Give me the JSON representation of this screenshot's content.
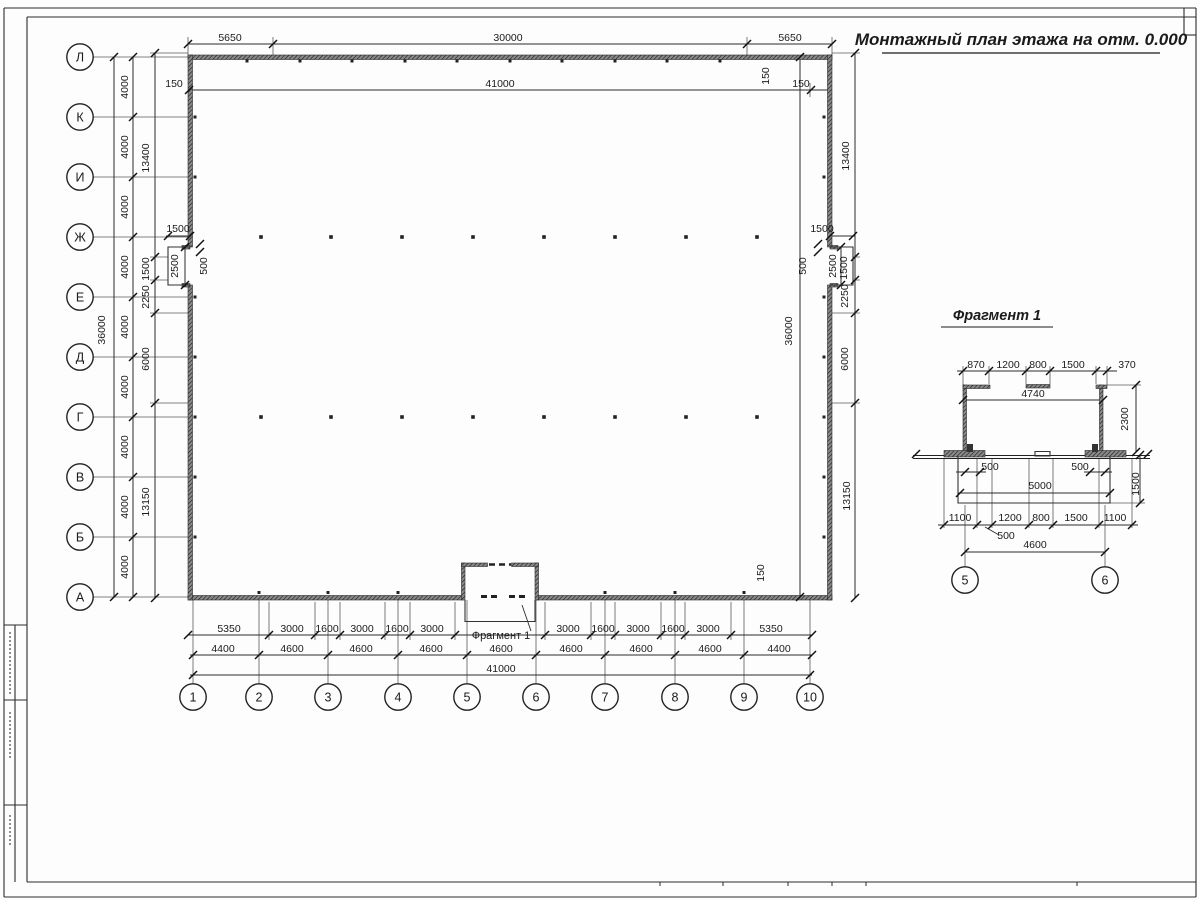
{
  "sheet": {
    "title": "Монтажный план этажа на отм. 0.000",
    "fragment_title": "Фрагмент 1",
    "fragment_callout": "Фрагмент 1"
  },
  "row_axes": [
    {
      "label": "Л",
      "y": 57
    },
    {
      "label": "К",
      "y": 117
    },
    {
      "label": "И",
      "y": 177
    },
    {
      "label": "Ж",
      "y": 237
    },
    {
      "label": "Е",
      "y": 297
    },
    {
      "label": "Д",
      "y": 357
    },
    {
      "label": "Г",
      "y": 417
    },
    {
      "label": "В",
      "y": 477
    },
    {
      "label": "Б",
      "y": 537
    },
    {
      "label": "А",
      "y": 597
    }
  ],
  "col_axes": [
    {
      "label": "1",
      "x": 193
    },
    {
      "label": "2",
      "x": 259
    },
    {
      "label": "3",
      "x": 328
    },
    {
      "label": "4",
      "x": 398
    },
    {
      "label": "5",
      "x": 467
    },
    {
      "label": "6",
      "x": 536
    },
    {
      "label": "7",
      "x": 605
    },
    {
      "label": "8",
      "x": 675
    },
    {
      "label": "9",
      "x": 744
    },
    {
      "label": "10",
      "x": 810
    }
  ],
  "frag_axes": [
    {
      "label": "5",
      "x": 965
    },
    {
      "label": "6",
      "x": 1105
    }
  ],
  "dim_labels": [
    {
      "t": "5650",
      "x": 230,
      "y": 41
    },
    {
      "t": "30000",
      "x": 508,
      "y": 41
    },
    {
      "t": "5650",
      "x": 790,
      "y": 41
    },
    {
      "t": "150",
      "x": 174,
      "y": 87
    },
    {
      "t": "41000",
      "x": 500,
      "y": 87
    },
    {
      "t": "150",
      "x": 801,
      "y": 87
    },
    {
      "t": "150",
      "x": 769,
      "y": 76,
      "r": 1
    },
    {
      "t": "36000",
      "x": 105,
      "y": 330,
      "r": 1
    },
    {
      "t": "4000",
      "x": 128,
      "y": 87,
      "r": 1
    },
    {
      "t": "4000",
      "x": 128,
      "y": 147,
      "r": 1
    },
    {
      "t": "4000",
      "x": 128,
      "y": 207,
      "r": 1
    },
    {
      "t": "4000",
      "x": 128,
      "y": 267,
      "r": 1
    },
    {
      "t": "4000",
      "x": 128,
      "y": 327,
      "r": 1
    },
    {
      "t": "4000",
      "x": 128,
      "y": 387,
      "r": 1
    },
    {
      "t": "4000",
      "x": 128,
      "y": 447,
      "r": 1
    },
    {
      "t": "4000",
      "x": 128,
      "y": 507,
      "r": 1
    },
    {
      "t": "4000",
      "x": 128,
      "y": 567,
      "r": 1
    },
    {
      "t": "13400",
      "x": 149,
      "y": 158,
      "r": 1
    },
    {
      "t": "1500",
      "x": 149,
      "y": 269,
      "r": 1
    },
    {
      "t": "2250",
      "x": 149,
      "y": 297,
      "r": 1
    },
    {
      "t": "6000",
      "x": 149,
      "y": 359,
      "r": 1
    },
    {
      "t": "13150",
      "x": 149,
      "y": 502,
      "r": 1
    },
    {
      "t": "1500",
      "x": 178,
      "y": 232
    },
    {
      "t": "2500",
      "x": 178,
      "y": 266,
      "r": 1
    },
    {
      "t": "500",
      "x": 207,
      "y": 266,
      "r": 1
    },
    {
      "t": "1500",
      "x": 822,
      "y": 232
    },
    {
      "t": "2500",
      "x": 836,
      "y": 266,
      "r": 1
    },
    {
      "t": "500",
      "x": 806,
      "y": 266,
      "r": 1
    },
    {
      "t": "13400",
      "x": 849,
      "y": 156,
      "r": 1
    },
    {
      "t": "1500",
      "x": 847,
      "y": 268,
      "r": 1
    },
    {
      "t": "2250",
      "x": 848,
      "y": 296,
      "r": 1
    },
    {
      "t": "6000",
      "x": 848,
      "y": 359,
      "r": 1
    },
    {
      "t": "13150",
      "x": 850,
      "y": 496,
      "r": 1
    },
    {
      "t": "36000",
      "x": 792,
      "y": 331,
      "r": 1
    },
    {
      "t": "150",
      "x": 764,
      "y": 573,
      "r": 1
    },
    {
      "t": "5350",
      "x": 229,
      "y": 632
    },
    {
      "t": "3000",
      "x": 292,
      "y": 632
    },
    {
      "t": "1600",
      "x": 327,
      "y": 632
    },
    {
      "t": "3000",
      "x": 362,
      "y": 632
    },
    {
      "t": "1600",
      "x": 397,
      "y": 632
    },
    {
      "t": "3000",
      "x": 432,
      "y": 632
    },
    {
      "t": "3000",
      "x": 568,
      "y": 632
    },
    {
      "t": "1600",
      "x": 603,
      "y": 632
    },
    {
      "t": "3000",
      "x": 638,
      "y": 632
    },
    {
      "t": "1600",
      "x": 673,
      "y": 632
    },
    {
      "t": "3000",
      "x": 708,
      "y": 632
    },
    {
      "t": "5350",
      "x": 771,
      "y": 632
    },
    {
      "t": "4400",
      "x": 223,
      "y": 652
    },
    {
      "t": "4600",
      "x": 292,
      "y": 652
    },
    {
      "t": "4600",
      "x": 361,
      "y": 652
    },
    {
      "t": "4600",
      "x": 431,
      "y": 652
    },
    {
      "t": "4600",
      "x": 501,
      "y": 652
    },
    {
      "t": "4600",
      "x": 571,
      "y": 652
    },
    {
      "t": "4600",
      "x": 641,
      "y": 652
    },
    {
      "t": "4600",
      "x": 710,
      "y": 652
    },
    {
      "t": "4400",
      "x": 779,
      "y": 652
    },
    {
      "t": "41000",
      "x": 501,
      "y": 672
    },
    {
      "t": "870",
      "x": 976,
      "y": 368
    },
    {
      "t": "1200",
      "x": 1008,
      "y": 368
    },
    {
      "t": "800",
      "x": 1038,
      "y": 368
    },
    {
      "t": "1500",
      "x": 1073,
      "y": 368
    },
    {
      "t": "370",
      "x": 1127,
      "y": 368
    },
    {
      "t": "4740",
      "x": 1033,
      "y": 397
    },
    {
      "t": "2300",
      "x": 1128,
      "y": 419,
      "r": 1
    },
    {
      "t": "500",
      "x": 990,
      "y": 470
    },
    {
      "t": "500",
      "x": 1080,
      "y": 470
    },
    {
      "t": "5000",
      "x": 1040,
      "y": 489
    },
    {
      "t": "1500",
      "x": 1139,
      "y": 484,
      "r": 1
    },
    {
      "t": "1100",
      "x": 960,
      "y": 521
    },
    {
      "t": "1200",
      "x": 1010,
      "y": 521
    },
    {
      "t": "800",
      "x": 1041,
      "y": 521
    },
    {
      "t": "1500",
      "x": 1076,
      "y": 521
    },
    {
      "t": "1100",
      "x": 1115,
      "y": 521
    },
    {
      "t": "500",
      "x": 1006,
      "y": 539
    },
    {
      "t": "4600",
      "x": 1035,
      "y": 548
    }
  ],
  "geometry": {
    "dim_h": [
      [
        44,
        188,
        832
      ],
      [
        90,
        188,
        832
      ],
      [
        635,
        188,
        812
      ],
      [
        655,
        190,
        812
      ],
      [
        675,
        190,
        812
      ],
      [
        236,
        166,
        191
      ],
      [
        236,
        830,
        855
      ],
      [
        371,
        957,
        1117
      ],
      [
        400,
        963,
        1103
      ],
      [
        493,
        958,
        1110
      ],
      [
        525,
        938,
        1138
      ],
      [
        552,
        965,
        1105
      ],
      [
        472,
        956,
        986
      ],
      [
        472,
        1084,
        1112
      ]
    ],
    "dim_v": [
      [
        114,
        57,
        597
      ],
      [
        133,
        57,
        597
      ],
      [
        155,
        53,
        598
      ],
      [
        800,
        57,
        597
      ],
      [
        855,
        53,
        598
      ],
      [
        185,
        247,
        285
      ],
      [
        841,
        247,
        285
      ],
      [
        1136,
        385,
        452
      ],
      [
        1140,
        455,
        503
      ]
    ],
    "ext_v": [
      [
        188,
        37,
        55
      ],
      [
        273,
        37,
        55
      ],
      [
        747,
        37,
        55
      ],
      [
        832,
        37,
        55
      ],
      [
        190,
        83,
        97
      ],
      [
        810,
        83,
        97
      ],
      [
        269,
        602,
        640
      ],
      [
        315,
        602,
        640
      ],
      [
        340,
        602,
        640
      ],
      [
        385,
        602,
        640
      ],
      [
        410,
        602,
        640
      ],
      [
        455,
        602,
        640
      ],
      [
        545,
        602,
        640
      ],
      [
        591,
        602,
        640
      ],
      [
        615,
        602,
        640
      ],
      [
        661,
        602,
        640
      ],
      [
        685,
        602,
        640
      ],
      [
        731,
        602,
        640
      ],
      [
        963,
        366,
        385
      ],
      [
        989,
        366,
        384
      ],
      [
        1026,
        366,
        384
      ],
      [
        1050,
        366,
        384
      ],
      [
        1096,
        366,
        384
      ],
      [
        1107,
        366,
        385
      ],
      [
        944,
        458,
        528
      ],
      [
        977,
        458,
        528
      ],
      [
        992,
        458,
        528
      ],
      [
        1029,
        458,
        528
      ],
      [
        1053,
        458,
        528
      ],
      [
        1099,
        458,
        528
      ],
      [
        1132,
        458,
        528
      ],
      [
        965,
        505,
        567
      ],
      [
        1105,
        505,
        567
      ]
    ],
    "ext_h": [
      [
        57,
        93,
        188
      ],
      [
        117,
        93,
        188
      ],
      [
        177,
        93,
        188
      ],
      [
        237,
        93,
        188
      ],
      [
        297,
        93,
        188
      ],
      [
        357,
        93,
        188
      ],
      [
        417,
        93,
        188
      ],
      [
        477,
        93,
        188
      ],
      [
        537,
        93,
        188
      ],
      [
        597,
        93,
        188
      ],
      [
        53,
        150,
        188
      ],
      [
        257,
        150,
        168
      ],
      [
        280,
        150,
        168
      ],
      [
        313,
        150,
        188
      ],
      [
        403,
        150,
        188
      ],
      [
        53,
        832,
        860
      ],
      [
        257,
        853,
        860
      ],
      [
        280,
        853,
        860
      ],
      [
        313,
        832,
        860
      ],
      [
        403,
        832,
        860
      ],
      [
        57,
        795,
        827
      ],
      [
        597,
        795,
        827
      ],
      [
        385,
        1107,
        1141
      ],
      [
        503,
        1110,
        1145
      ]
    ],
    "axis_ext_v_y": [
      600,
      684
    ],
    "ticks": [
      [
        188,
        44
      ],
      [
        273,
        44
      ],
      [
        747,
        44
      ],
      [
        832,
        44
      ],
      [
        189,
        90
      ],
      [
        811,
        90
      ],
      [
        188,
        635
      ],
      [
        269,
        635
      ],
      [
        315,
        635
      ],
      [
        340,
        635
      ],
      [
        385,
        635
      ],
      [
        410,
        635
      ],
      [
        455,
        635
      ],
      [
        545,
        635
      ],
      [
        591,
        635
      ],
      [
        615,
        635
      ],
      [
        661,
        635
      ],
      [
        685,
        635
      ],
      [
        731,
        635
      ],
      [
        812,
        635
      ],
      [
        193,
        655
      ],
      [
        259,
        655
      ],
      [
        328,
        655
      ],
      [
        398,
        655
      ],
      [
        467,
        655
      ],
      [
        536,
        655
      ],
      [
        605,
        655
      ],
      [
        675,
        655
      ],
      [
        744,
        655
      ],
      [
        812,
        655
      ],
      [
        193,
        675
      ],
      [
        810,
        675
      ],
      [
        114,
        57
      ],
      [
        114,
        597
      ],
      [
        133,
        57
      ],
      [
        133,
        117
      ],
      [
        133,
        177
      ],
      [
        133,
        237
      ],
      [
        133,
        297
      ],
      [
        133,
        357
      ],
      [
        133,
        417
      ],
      [
        133,
        477
      ],
      [
        133,
        537
      ],
      [
        133,
        597
      ],
      [
        155,
        53
      ],
      [
        155,
        257
      ],
      [
        155,
        280
      ],
      [
        155,
        313
      ],
      [
        155,
        403
      ],
      [
        155,
        598
      ],
      [
        800,
        57
      ],
      [
        800,
        597
      ],
      [
        855,
        53
      ],
      [
        855,
        257
      ],
      [
        855,
        280
      ],
      [
        855,
        313
      ],
      [
        855,
        403
      ],
      [
        855,
        598
      ],
      [
        168,
        236
      ],
      [
        190,
        236
      ],
      [
        830,
        236
      ],
      [
        853,
        236
      ],
      [
        185,
        247
      ],
      [
        185,
        285
      ],
      [
        841,
        247
      ],
      [
        841,
        285
      ],
      [
        200,
        244
      ],
      [
        200,
        252
      ],
      [
        818,
        244
      ],
      [
        818,
        252
      ],
      [
        963,
        371
      ],
      [
        989,
        371
      ],
      [
        1026,
        371
      ],
      [
        1050,
        371
      ],
      [
        1096,
        371
      ],
      [
        1107,
        371
      ],
      [
        963,
        400
      ],
      [
        1103,
        400
      ],
      [
        1136,
        385
      ],
      [
        1136,
        452
      ],
      [
        965,
        472
      ],
      [
        980,
        472
      ],
      [
        1090,
        472
      ],
      [
        1105,
        472
      ],
      [
        960,
        493
      ],
      [
        1110,
        493
      ],
      [
        1140,
        455
      ],
      [
        1140,
        503
      ],
      [
        944,
        525
      ],
      [
        977,
        525
      ],
      [
        992,
        525
      ],
      [
        1029,
        525
      ],
      [
        1053,
        525
      ],
      [
        1099,
        525
      ],
      [
        1132,
        525
      ],
      [
        965,
        552
      ],
      [
        1105,
        552
      ],
      [
        916,
        454
      ],
      [
        1148,
        454
      ]
    ],
    "walls": [
      [
        188,
        55,
        644,
        4.5
      ],
      [
        188,
        595.5,
        275,
        4.5
      ],
      [
        537,
        595.5,
        295,
        4.5
      ],
      [
        188,
        55,
        4.5,
        192
      ],
      [
        188,
        285,
        4.5,
        315
      ],
      [
        827.5,
        55,
        4.5,
        192
      ],
      [
        827.5,
        285,
        4.5,
        315
      ],
      [
        461.5,
        563,
        3.5,
        37
      ],
      [
        535,
        563,
        3.5,
        37
      ],
      [
        461.5,
        563,
        26,
        3.5
      ],
      [
        511.5,
        563,
        27,
        3.5
      ],
      [
        182,
        245.5,
        8,
        3.5
      ],
      [
        182,
        283.5,
        8,
        3.5
      ],
      [
        830,
        245.5,
        8,
        3.5
      ],
      [
        830,
        283.5,
        8,
        3.5
      ],
      [
        963,
        385,
        3.5,
        67
      ],
      [
        963,
        385,
        27,
        3.5
      ],
      [
        1099.5,
        385,
        3.5,
        67
      ],
      [
        1096,
        385,
        11,
        3.5
      ],
      [
        1026,
        384.5,
        24,
        3.5
      ],
      [
        944,
        450.5,
        41,
        6.5
      ],
      [
        1085,
        450.5,
        41,
        6.5
      ]
    ],
    "solids": [
      [
        967,
        444,
        6,
        8
      ],
      [
        1092,
        444,
        6,
        8
      ]
    ],
    "outlines": [
      "M190,247 L168,247 L168,285 L190,285",
      "M830,247 L853,247 L853,285 L830,285",
      "M465,600 L465,621.5 L535,621.5 L535,600",
      "M958,456 L958,503 L1110,503 L1110,456",
      "M1035,451.5 h15 v4.5 h-15 Z"
    ],
    "ground_h": [
      [
        455.5,
        913,
        1150
      ],
      [
        458.5,
        913,
        1150
      ]
    ],
    "dashes": [
      {
        "x1": 489,
        "y1": 564.5,
        "x2": 511,
        "y2": 564.5,
        "w": 2.5
      },
      {
        "x1": 481,
        "y1": 596.5,
        "x2": 499,
        "y2": 596.5,
        "w": 3
      },
      {
        "x1": 509,
        "y1": 596.5,
        "x2": 527,
        "y2": 596.5,
        "w": 3
      }
    ],
    "leaders": [
      [
        522,
        605,
        531,
        631
      ],
      [
        985,
        527,
        999,
        535
      ]
    ],
    "dots_rows_y": [
      237,
      417
    ],
    "dots_x": [
      261,
      331,
      402,
      473,
      544,
      615,
      686,
      757
    ],
    "studs_top": [
      247,
      300,
      352,
      405,
      457,
      510,
      562,
      615,
      667,
      720
    ],
    "studs_bottom": [
      259,
      328,
      398,
      605,
      675,
      744
    ],
    "studs_side_y": [
      117,
      177,
      297,
      357,
      417,
      477,
      537
    ],
    "frame_h": [
      [
        8,
        4,
        1196
      ],
      [
        17,
        27,
        1196
      ],
      [
        882,
        27,
        1196
      ],
      [
        897,
        4,
        1196
      ],
      [
        625,
        4,
        27
      ],
      [
        700,
        4,
        27
      ],
      [
        805,
        4,
        27
      ],
      [
        35,
        1184,
        1196
      ]
    ],
    "frame_v": [
      [
        4,
        8,
        897
      ],
      [
        27,
        17,
        882
      ],
      [
        1196,
        8,
        897
      ],
      [
        15,
        625,
        882
      ],
      [
        1184,
        8,
        35
      ]
    ],
    "micro_text_v": [
      [
        10,
        632,
        695
      ],
      [
        10,
        712,
        760
      ],
      [
        10,
        815,
        845
      ]
    ],
    "stamp_ticks_x": [
      660,
      723,
      788,
      832,
      866,
      1077
    ],
    "title_underline": [
      882,
      1160,
      53
    ],
    "frag_title_underline": [
      941,
      1053,
      327
    ],
    "colors": {
      "line": "#2b2b2b",
      "ext": "#5a5a5a",
      "wall_base": "#8a8a8a",
      "wall_hatch": "#1e1e1e",
      "text": "#1b1b1b"
    }
  }
}
